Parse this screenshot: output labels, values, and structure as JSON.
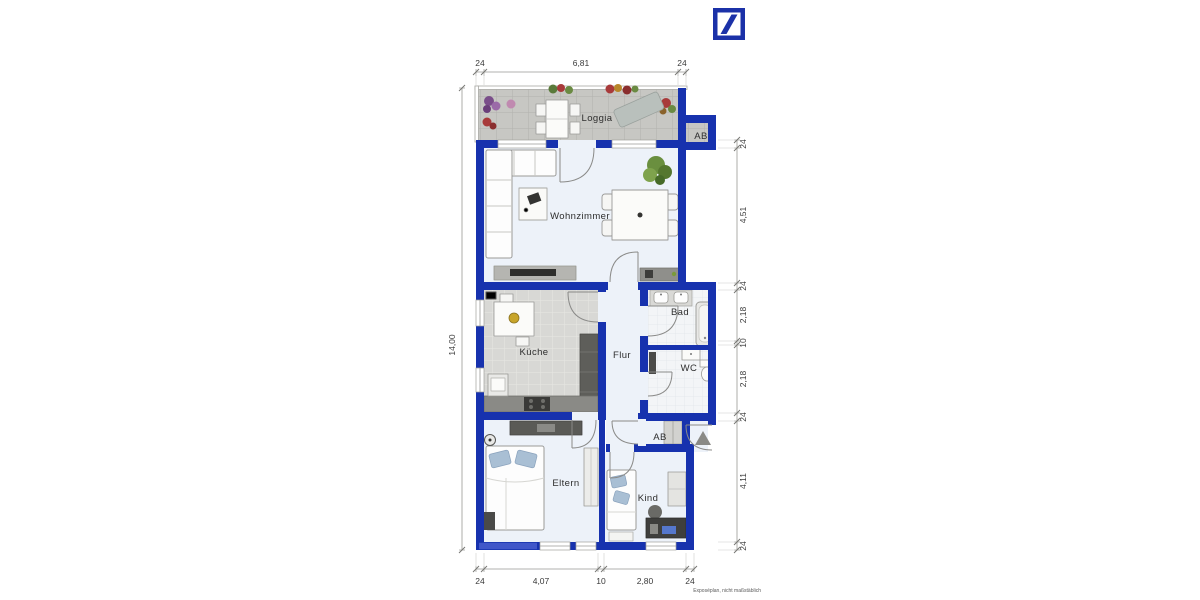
{
  "logo": {
    "name": "Deutsche Bank logo"
  },
  "plan": {
    "rooms": {
      "loggia": "Loggia",
      "ab_loggia": "AB",
      "wohnzimmer": "Wohnzimmer",
      "kueche": "Küche",
      "flur": "Flur",
      "bad": "Bad",
      "wc": "WC",
      "ab_flur": "AB",
      "eltern": "Eltern",
      "kind": "Kind"
    },
    "dims": {
      "top": [
        "24",
        "6,81",
        "24"
      ],
      "left": [
        "14,00"
      ],
      "right": [
        "24",
        "4,51",
        "24",
        "2,18",
        "10",
        "2,18",
        "24",
        "4,11",
        "24"
      ],
      "bottom": [
        "24",
        "4,07",
        "10",
        "2,80",
        "24"
      ]
    },
    "disclaimer": "Exposéplan, nicht maßstäblich"
  },
  "colors": {
    "wall": "#1732ae",
    "logo_blue": "#1b31a8",
    "floor": "#edf2f9",
    "tile_loggia": "#c7c7c3",
    "tile_kitchen": "#d8d8d5",
    "tile_bath": "#f3f5f7",
    "pillow": "#a9bfd4"
  }
}
